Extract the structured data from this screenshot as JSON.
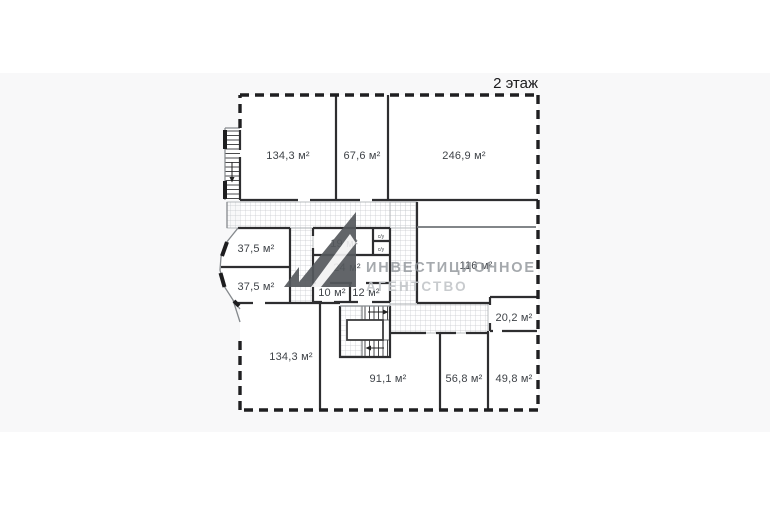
{
  "plan": {
    "floor_label": "2 этаж",
    "rooms": {
      "top_left": {
        "label": "134,3 м²"
      },
      "top_middle": {
        "label": "67,6 м²"
      },
      "top_right": {
        "label": "246,9 м²"
      },
      "left_upper": {
        "label": "37,5 м²"
      },
      "left_lower": {
        "label": "37,5 м²"
      },
      "center_small": {
        "label": "19 м²"
      },
      "center_main": {
        "label": "24 м²"
      },
      "center_a": {
        "label": "10 м²"
      },
      "center_b": {
        "label": "12 м²"
      },
      "right_large": {
        "label": "116 м²"
      },
      "right_small": {
        "label": "20,2 м²"
      },
      "bottom_left": {
        "label": "134,3 м²"
      },
      "bottom_middle": {
        "label": "91,1 м²"
      },
      "bottom_small_a": {
        "label": "56,8 м²"
      },
      "bottom_small_b": {
        "label": "49,8 м²"
      },
      "wc_top": {
        "label": "с/у"
      },
      "wc_bottom": {
        "label": "с/у"
      }
    },
    "colors": {
      "wall": "#2e2e30",
      "wall_light": "#85898d",
      "hatch_line": "#c6c9cd",
      "room_fill": "#ffffff",
      "background_band": "#f8f8f9",
      "label_text": "#3f4348"
    }
  },
  "watermark": {
    "line1": "ИНВЕСТИЦИОННОЕ",
    "line2": "АГЕНТСТВО",
    "logo_color": "#55595d",
    "text_color_primary": "#8f9499",
    "text_color_secondary": "#c3c6c9"
  }
}
